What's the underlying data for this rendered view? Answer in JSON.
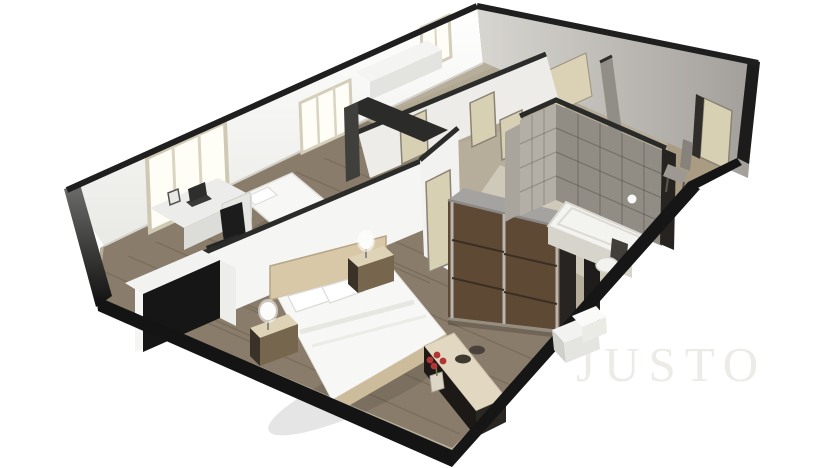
{
  "watermark": {
    "text": "JUSTO"
  },
  "palette": {
    "background": "#ffffff",
    "slab": "#141414",
    "wall_light": "#f5f5f3",
    "wall_gray": "#c9c7c2",
    "floor_wood": "#897c6a",
    "floor_hall": "#b6ad9b",
    "floor_bath": "#cfc9ba",
    "floor_entry": "#a99c83",
    "tile_dark": "#918c84",
    "tile_light": "#b4afa6",
    "door": "#d8d0b3",
    "wardrobe_wood": "#5e4935",
    "bedding": "#f7f7f5",
    "headboard": "#d9c8a8",
    "nightstand": "#dfd3b7",
    "lamp": "#fcfcfa",
    "accent_flower": "#b23434",
    "furniture_black": "#161616",
    "desk": "#ececea",
    "window_glow": "#fefdf6"
  },
  "scene": {
    "type": "3d-isometric-floor-plan",
    "rooms": [
      "master-bedroom",
      "second-bedroom",
      "hallway",
      "bathroom",
      "entry-room"
    ],
    "furniture": [
      "double-bed",
      "single-bed",
      "wardrobe",
      "desk",
      "office-chair",
      "dresser",
      "nightstands",
      "lamps",
      "bench-console",
      "bathtub",
      "toilet",
      "dining-chair",
      "kitchen-counter",
      "tall-cabinet"
    ]
  }
}
